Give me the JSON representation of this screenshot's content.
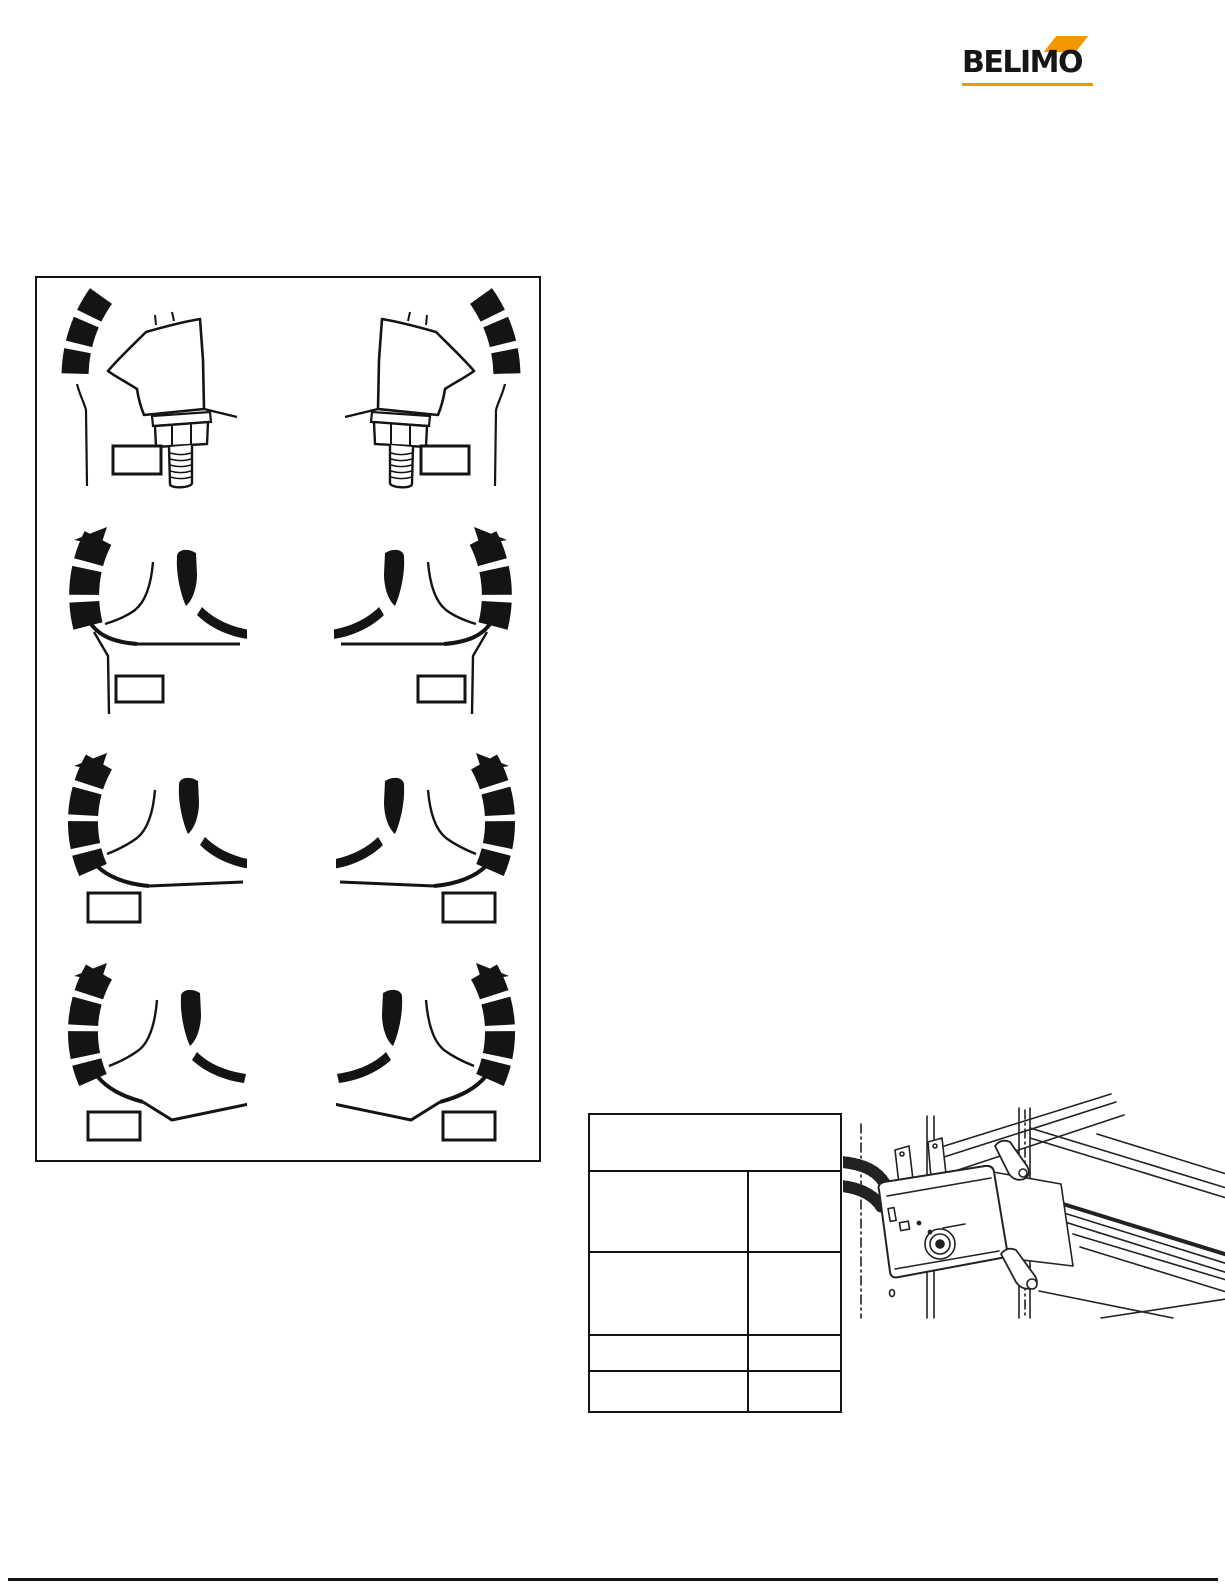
{
  "page": {
    "width": 1225,
    "height": 1585,
    "background": "#ffffff",
    "ink": "#141414"
  },
  "logo": {
    "text": "BELIMO",
    "accent_color": "#F49600",
    "text_color": "#161616"
  },
  "diagram_panel": {
    "rows": 4,
    "columns": 2,
    "description_visible_text": "",
    "label_boxes": [
      "",
      "",
      "",
      "",
      "",
      "",
      "",
      ""
    ]
  },
  "table": {
    "header_text": "",
    "rows": [
      [
        "",
        ""
      ],
      [
        "",
        ""
      ],
      [
        "",
        ""
      ],
      [
        "",
        ""
      ]
    ]
  },
  "illustration": {
    "caption_visible_text": ""
  }
}
